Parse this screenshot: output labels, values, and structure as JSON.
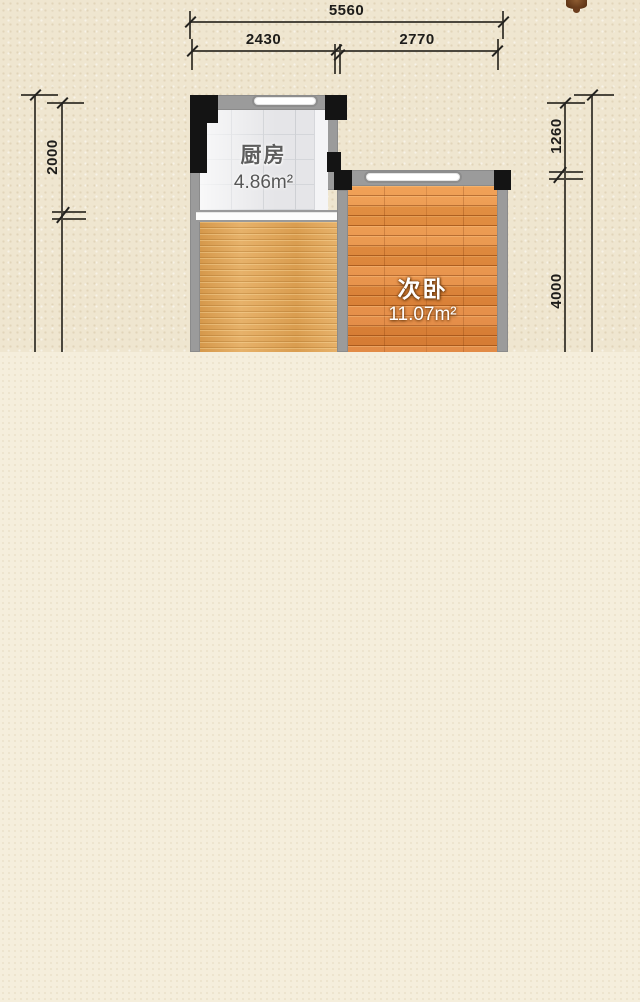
{
  "image": {
    "type": "floor-plan",
    "background_top": "#efe6d0",
    "background_bottom": "#f5eedc"
  },
  "dimensions": {
    "total_width": "5560",
    "width_left": "2430",
    "width_right": "2770",
    "left_height": "2000",
    "right_top": "1260",
    "right_bottom": "4000"
  },
  "rooms": {
    "kitchen": {
      "name": "厨房",
      "area": "4.86m²"
    },
    "bedroom": {
      "name": "次卧",
      "area": "11.07m²"
    }
  },
  "colors": {
    "wall": "#9b9b9b",
    "pier": "#141414",
    "dimension_line": "#4b473d",
    "dimension_text": "#1d1c1a",
    "kitchen_floor": "#e5e5e8",
    "bedroom_floor": "#e78d3e",
    "lower_room_floor": "#e0a355",
    "window": "#ffffff",
    "decor_blob": "#5f3516"
  }
}
